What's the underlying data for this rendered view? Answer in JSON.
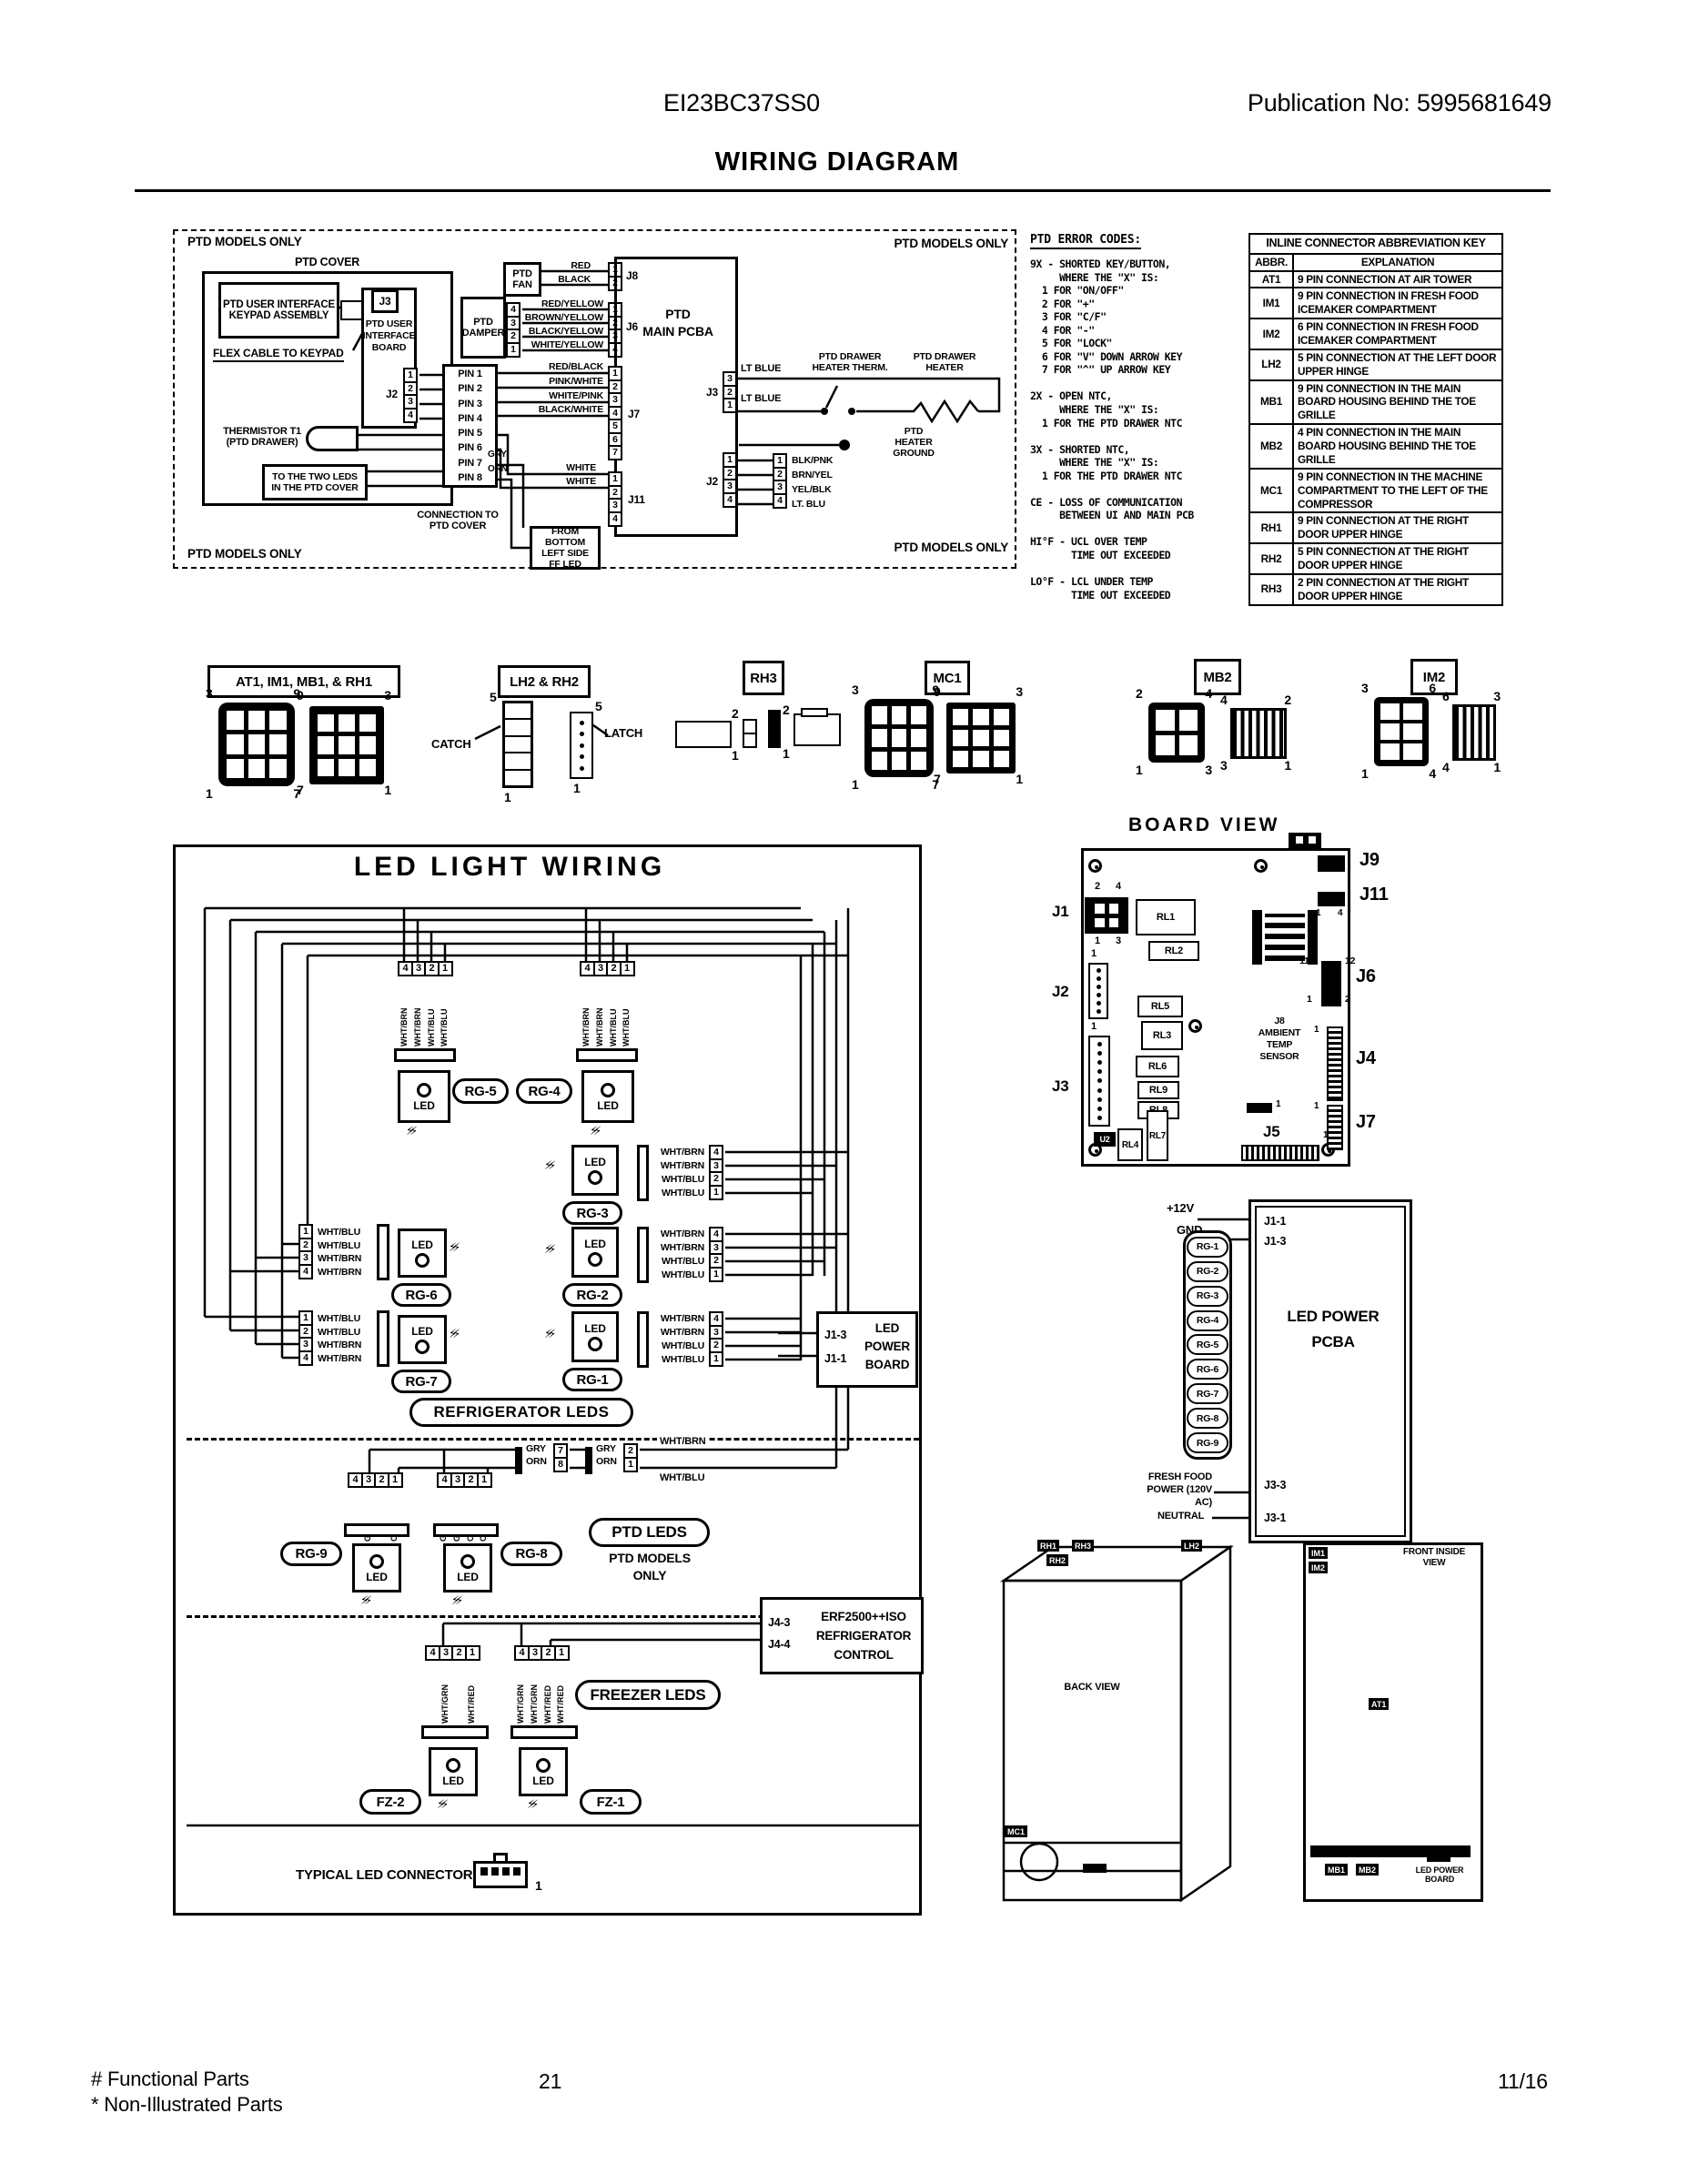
{
  "header": {
    "model": "EI23BC37SS0",
    "publication": "Publication No:  5995681649",
    "title": "WIRING DIAGRAM"
  },
  "ptd": {
    "models_only": "PTD MODELS ONLY",
    "cover": "PTD COVER",
    "keypad": "PTD USER INTERFACE\nKEYPAD ASSEMBLY",
    "j3": "J3",
    "ui_board": "PTD USER\nINTERFACE\nBOARD",
    "flex_cable": "FLEX CABLE TO KEYPAD",
    "j2": "J2",
    "j2_pins": [
      "1",
      "2",
      "3",
      "4"
    ],
    "pins": [
      "PIN 1",
      "PIN 2",
      "PIN 3",
      "PIN 4",
      "PIN 5",
      "PIN 6",
      "PIN 7",
      "PIN 8"
    ],
    "thermistor": "THERMISTOR T1\n(PTD DRAWER)",
    "two_leds": "TO THE TWO LEDS\nIN THE PTD COVER",
    "connection": "CONNECTION TO\nPTD COVER",
    "gry": "GRY",
    "orn": "ORN",
    "fan": "PTD\nFAN",
    "fan_wires": [
      "RED",
      "BLACK"
    ],
    "j8": "J8",
    "j8_pins": [
      "1",
      "2"
    ],
    "damper": "PTD\nDAMPER",
    "damper_pins": [
      "4",
      "3",
      "2",
      "1"
    ],
    "damper_wires": [
      "RED/YELLOW",
      "BROWN/YELLOW",
      "BLACK/YELLOW",
      "WHITE/YELLOW"
    ],
    "j6": "J6",
    "j6_pins": [
      "1",
      "2",
      "3",
      "4"
    ],
    "main_pcba": "PTD\nMAIN PCBA",
    "j7_wires": [
      "RED/BLACK",
      "PINK/WHITE",
      "WHITE/PINK",
      "BLACK/WHITE"
    ],
    "j7": "J7",
    "j7_pins": [
      "1",
      "2",
      "3",
      "4",
      "5",
      "6",
      "7"
    ],
    "white1": "WHITE",
    "white2": "WHITE",
    "j11": "J11",
    "j11_pins": [
      "1",
      "2",
      "3",
      "4"
    ],
    "ff_led": "FROM BOTTOM\nLEFT SIDE\nFF LED",
    "j3r": "J3",
    "j3r_pins": [
      "3",
      "2",
      "1"
    ],
    "lt_blue1": "LT BLUE",
    "lt_blue2": "LT BLUE",
    "heater_therm": "PTD DRAWER\nHEATER THERM.",
    "heater": "PTD DRAWER\nHEATER",
    "heater_ground": "PTD\nHEATER\nGROUND",
    "j2r": "J2",
    "j2r_pins": [
      "1",
      "2",
      "3",
      "4"
    ],
    "j2r_wires": [
      "BLK/PNK",
      "BRN/YEL",
      "YEL/BLK",
      "LT. BLU"
    ]
  },
  "error_codes": {
    "title": "PTD ERROR CODES:",
    "body": "9X - SHORTED KEY/BUTTON,\n     WHERE THE \"X\" IS:\n  1 FOR \"ON/OFF\"\n  2 FOR \"+\"\n  3 FOR \"C/F\"\n  4 FOR \"-\"\n  5 FOR \"LOCK\"\n  6 FOR \"V\" DOWN ARROW KEY\n  7 FOR \"^\" UP ARROW KEY\n\n2X - OPEN NTC,\n     WHERE THE \"X\" IS:\n  1 FOR THE PTD DRAWER NTC\n\n3X - SHORTED NTC,\n     WHERE THE \"X\" IS:\n  1 FOR THE PTD DRAWER NTC\n\nCE - LOSS OF COMMUNICATION\n     BETWEEN UI AND MAIN PCB\n\nHI°F - UCL OVER TEMP\n       TIME OUT EXCEEDED\n\nLO°F - LCL UNDER TEMP\n       TIME OUT EXCEEDED"
  },
  "abbr_key": {
    "title": "INLINE CONNECTOR ABBREVIATION KEY",
    "col_abbr": "ABBR.",
    "col_expl": "EXPLANATION",
    "rows": [
      {
        "abbr": "AT1",
        "text": "9 PIN CONNECTION AT AIR TOWER"
      },
      {
        "abbr": "IM1",
        "text": "9 PIN CONNECTION IN FRESH FOOD ICEMAKER COMPARTMENT"
      },
      {
        "abbr": "IM2",
        "text": "6 PIN CONNECTION IN FRESH FOOD ICEMAKER COMPARTMENT"
      },
      {
        "abbr": "LH2",
        "text": "5 PIN CONNECTION AT THE LEFT DOOR UPPER HINGE"
      },
      {
        "abbr": "MB1",
        "text": "9 PIN CONNECTION IN THE MAIN BOARD HOUSING BEHIND THE TOE GRILLE"
      },
      {
        "abbr": "MB2",
        "text": "4 PIN CONNECTION IN THE MAIN BOARD HOUSING BEHIND THE TOE GRILLE"
      },
      {
        "abbr": "MC1",
        "text": "9 PIN CONNECTION IN THE MACHINE COMPARTMENT TO THE LEFT OF THE COMPRESSOR"
      },
      {
        "abbr": "RH1",
        "text": "9 PIN CONNECTION AT THE RIGHT DOOR UPPER HINGE"
      },
      {
        "abbr": "RH2",
        "text": "5 PIN CONNECTION AT THE RIGHT DOOR UPPER HINGE"
      },
      {
        "abbr": "RH3",
        "text": "2 PIN CONNECTION AT THE RIGHT DOOR UPPER HINGE"
      }
    ]
  },
  "connectors": {
    "g1_label": "AT1, IM1, MB1, & RH1",
    "g1a": {
      "tl": "3",
      "tr": "9",
      "bl": "1",
      "br": "7"
    },
    "g1b": {
      "tl": "9",
      "tr": "3",
      "bl": "7",
      "br": "1"
    },
    "g2_label": "LH2 & RH2",
    "catch": "CATCH",
    "latch": "LATCH",
    "g2a": {
      "t": "5",
      "b": "1"
    },
    "g2b": {
      "t": "5",
      "b": "1"
    },
    "g3_label": "RH3",
    "g3a": {
      "t": "2",
      "b": "1"
    },
    "g3b": {
      "t": "2",
      "b": "1"
    },
    "g4_label": "MC1",
    "g4a": {
      "tl": "3",
      "tr": "9",
      "bl": "1",
      "br": "7"
    },
    "g4b": {
      "tl": "9",
      "tr": "3",
      "bl": "7",
      "br": "1"
    },
    "g5_label": "MB2",
    "g5a": {
      "tl": "2",
      "tr": "4",
      "bl": "1",
      "br": "3"
    },
    "g5b": {
      "tl": "4",
      "tr": "2",
      "bl": "3",
      "br": "1"
    },
    "g6_label": "IM2",
    "g6a": {
      "tl": "3",
      "tr": "6",
      "bl": "1",
      "br": "4"
    },
    "g6b": {
      "tl": "6",
      "tr": "3",
      "bl": "4",
      "br": "1"
    }
  },
  "led_wiring": {
    "title": "LED LIGHT WIRING",
    "led": "LED",
    "rg5": {
      "name": "RG-5",
      "pins": [
        "4",
        "3",
        "2",
        "1"
      ],
      "wires": [
        "WHT/BRN",
        "WHT/BRN",
        "WHT/BLU",
        "WHT/BLU"
      ]
    },
    "rg4": {
      "name": "RG-4",
      "pins": [
        "4",
        "3",
        "2",
        "1"
      ],
      "wires": [
        "WHT/BRN",
        "WHT/BRN",
        "WHT/BLU",
        "WHT/BLU"
      ]
    },
    "rg6": {
      "name": "RG-6",
      "pins": [
        "1",
        "2",
        "3",
        "4"
      ],
      "wires": [
        "WHT/BLU",
        "WHT/BLU",
        "WHT/BRN",
        "WHT/BRN"
      ]
    },
    "rg7": {
      "name": "RG-7",
      "pins": [
        "1",
        "2",
        "3",
        "4"
      ],
      "wires": [
        "WHT/BLU",
        "WHT/BLU",
        "WHT/BRN",
        "WHT/BRN"
      ]
    },
    "rg3": {
      "name": "RG-3",
      "pins": [
        "4",
        "3",
        "2",
        "1"
      ],
      "wires": [
        "WHT/BRN",
        "WHT/BRN",
        "WHT/BLU",
        "WHT/BLU"
      ]
    },
    "rg2": {
      "name": "RG-2",
      "pins": [
        "4",
        "3",
        "2",
        "1"
      ],
      "wires": [
        "WHT/BRN",
        "WHT/BRN",
        "WHT/BLU",
        "WHT/BLU"
      ]
    },
    "rg1": {
      "name": "RG-1",
      "pins": [
        "4",
        "3",
        "2",
        "1"
      ],
      "wires": [
        "WHT/BRN",
        "WHT/BRN",
        "WHT/BLU",
        "WHT/BLU"
      ]
    },
    "refrigerator_leds": "REFRIGERATOR LEDS",
    "power_board": {
      "j13": "J1-3",
      "j11": "J1-1",
      "label": "LED\nPOWER\nBOARD"
    },
    "rg9": {
      "name": "RG-9",
      "pins": [
        "4",
        "3",
        "2",
        "1"
      ],
      "wires": [
        "",
        "GRY",
        "",
        "ORN"
      ]
    },
    "rg8": {
      "name": "RG-8",
      "pins": [
        "4",
        "3",
        "2",
        "1"
      ],
      "wires": [
        "GRY",
        "GRY",
        "ORN",
        "ORN"
      ]
    },
    "inline1": {
      "gry": "GRY",
      "orn": "ORN",
      "pins": [
        "7",
        "8"
      ]
    },
    "inline2": {
      "gry": "GRY",
      "orn": "ORN",
      "pins": [
        "2",
        "1"
      ]
    },
    "wht_brn": "WHT/BRN",
    "wht_blu": "WHT/BLU",
    "ptd_leds": "PTD LEDS",
    "ptd_models_only": "PTD MODELS\nONLY",
    "fz2": {
      "name": "FZ-2",
      "pins": [
        "4",
        "3",
        "2",
        "1"
      ],
      "wires": [
        "",
        "WHT/GRN",
        "",
        "WHT/RED"
      ]
    },
    "fz1": {
      "name": "FZ-1",
      "pins": [
        "4",
        "3",
        "2",
        "1"
      ],
      "wires": [
        "WHT/GRN",
        "WHT/GRN",
        "WHT/RED",
        "WHT/RED"
      ]
    },
    "freezer_leds": "FREEZER LEDS",
    "control": {
      "j43": "J4-3",
      "j44": "J4-4",
      "label": "ERF2500++ISO\nREFRIGERATOR\nCONTROL"
    },
    "typical": "TYPICAL LED CONNECTOR",
    "typical_pin": "1"
  },
  "board_view": {
    "title": "BOARD VIEW",
    "j1": "J1",
    "j2": "J2",
    "j3": "J3",
    "j4": "J4",
    "j5": "J5",
    "j6": "J6",
    "j7": "J7",
    "j9": "J9",
    "j11": "J11",
    "rl1": "RL1",
    "rl2": "RL2",
    "rl3": "RL3",
    "rl4": "RL4",
    "rl5": "RL5",
    "rl6": "RL6",
    "rl7": "RL7",
    "rl8": "RL8",
    "rl9": "RL9",
    "u2": "U2",
    "sensor": "J8\nAMBIENT\nTEMP\nSENSOR",
    "j1_tl": "2",
    "j1_tr": "4",
    "j1_bl": "1",
    "j1_br": "3",
    "j2_pin": "1",
    "j3_pin": "1",
    "j11_l": "1",
    "j11_r": "4",
    "j6_tl": "11",
    "j6_tr": "12",
    "j6_bl": "1",
    "j6_br": "2",
    "j4_pin": "1",
    "j7_pin": "1",
    "j5_pin": "1",
    "aux_pin": "1"
  },
  "led_power": {
    "v12": "+12V",
    "gnd": "GND",
    "channels": [
      "RG-1",
      "RG-2",
      "RG-3",
      "RG-4",
      "RG-5",
      "RG-6",
      "RG-7",
      "RG-8",
      "RG-9"
    ],
    "j1_1": "J1-1",
    "j1_3": "J1-3",
    "pcba": "LED POWER\nPCBA",
    "j3_3": "J3-3",
    "j3_1": "J3-1",
    "fresh_food": "FRESH FOOD\nPOWER (120V AC)",
    "neutral": "NEUTRAL"
  },
  "views": {
    "back": {
      "title": "BACK VIEW",
      "rh1": "RH1",
      "rh3": "RH3",
      "rh2": "RH2",
      "lh2": "LH2",
      "mc1": "MC1"
    },
    "front": {
      "title": "FRONT INSIDE\nVIEW",
      "im1": "IM1",
      "im2": "IM2",
      "at1": "AT1",
      "mb1": "MB1",
      "mb2": "MB2",
      "led_power_board": "LED POWER\nBOARD"
    }
  },
  "footer": {
    "functional": "# Functional Parts",
    "non_illustrated": "* Non-Illustrated Parts",
    "page": "21",
    "date": "11/16"
  }
}
